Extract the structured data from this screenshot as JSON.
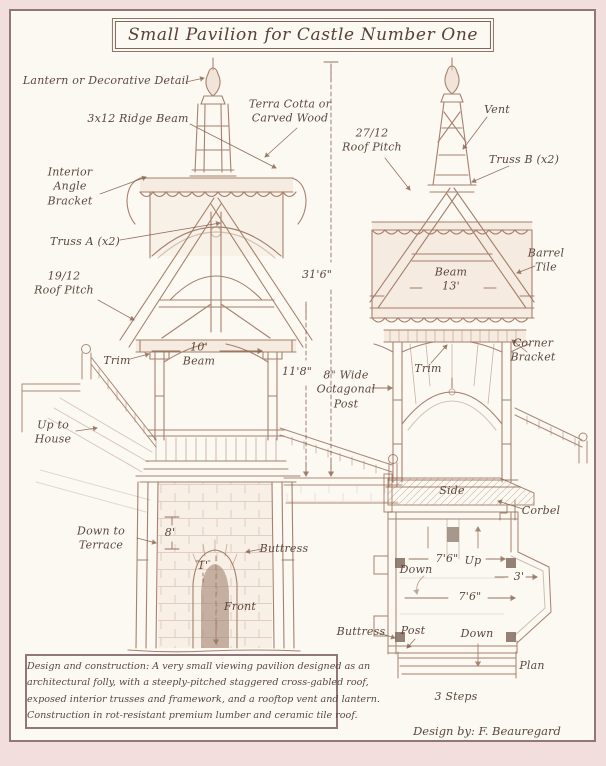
{
  "title": {
    "text": "Small Pavilion for Castle Number One"
  },
  "credit": {
    "text": "Design by: F. Beauregard"
  },
  "note_box": {
    "lines": [
      "Design and construction: A very small viewing pavilion designed as an",
      "architectural folly, with a steeply-pitched staggered cross-gabled roof,",
      "exposed interior trusses and framework, and a rooftop vent and lantern.",
      "Construction in rot-resistant premium lumber and ceramic tile roof."
    ]
  },
  "colors": {
    "margin": "#f1dedd",
    "frame": "#90777a",
    "paper": "#fcf9f3",
    "ink": "#8a5a42",
    "label": "#5c473d",
    "title": "#584237"
  },
  "annotations": [
    {
      "name": "lantern-detail",
      "text": "Lantern or Decorative Detail",
      "x": 106,
      "y": 81
    },
    {
      "name": "ridge-beam",
      "text": "3x12 Ridge Beam",
      "x": 138,
      "y": 119
    },
    {
      "name": "interior-angle-bracket",
      "text": "Interior\nAngle\nBracket",
      "x": 70,
      "y": 187
    },
    {
      "name": "truss-a",
      "text": "Truss A (x2)",
      "x": 85,
      "y": 242
    },
    {
      "name": "roof-pitch-19-12",
      "text": "19/12\nRoof Pitch",
      "x": 64,
      "y": 284
    },
    {
      "name": "terra-cotta",
      "text": "Terra Cotta or\nCarved Wood",
      "x": 290,
      "y": 112
    },
    {
      "name": "roof-pitch-27-12",
      "text": "27/12\nRoof Pitch",
      "x": 372,
      "y": 141
    },
    {
      "name": "vent",
      "text": "Vent",
      "x": 497,
      "y": 110
    },
    {
      "name": "truss-b",
      "text": "Truss B (x2)",
      "x": 524,
      "y": 160
    },
    {
      "name": "barrel-tile",
      "text": "Barrel\nTile",
      "x": 546,
      "y": 261
    },
    {
      "name": "beam-13",
      "text": "Beam\n13'",
      "x": 451,
      "y": 280
    },
    {
      "name": "corner-bracket",
      "text": "Corner\nBracket",
      "x": 533,
      "y": 351
    },
    {
      "name": "trim-left",
      "text": "Trim",
      "x": 117,
      "y": 361
    },
    {
      "name": "beam-10",
      "text": "10'\nBeam",
      "x": 199,
      "y": 355
    },
    {
      "name": "trim-right",
      "text": "Trim",
      "x": 428,
      "y": 369
    },
    {
      "name": "dim-31-6",
      "text": "31'6\"",
      "x": 317,
      "y": 275
    },
    {
      "name": "dim-11-8",
      "text": "11'8\"",
      "x": 297,
      "y": 372
    },
    {
      "name": "octagonal-post",
      "text": "8\" Wide\nOctagonal\nPost",
      "x": 346,
      "y": 390
    },
    {
      "name": "up-to-house",
      "text": "Up to\nHouse",
      "x": 53,
      "y": 433
    },
    {
      "name": "down-to-terrace",
      "text": "Down to\nTerrace",
      "x": 101,
      "y": 539
    },
    {
      "name": "dim-8",
      "text": "8'",
      "x": 170,
      "y": 533
    },
    {
      "name": "buttress-left",
      "text": "Buttress",
      "x": 284,
      "y": 549
    },
    {
      "name": "dim-1",
      "text": "1'",
      "x": 203,
      "y": 566
    },
    {
      "name": "front-view",
      "text": "Front",
      "x": 240,
      "y": 607
    },
    {
      "name": "side-view",
      "text": "Side",
      "x": 452,
      "y": 491
    },
    {
      "name": "corbel",
      "text": "Corbel",
      "x": 541,
      "y": 511
    },
    {
      "name": "down-plan-upper",
      "text": "Down",
      "x": 416,
      "y": 570
    },
    {
      "name": "dim-7-6-upper",
      "text": "7'6\"",
      "x": 447,
      "y": 559
    },
    {
      "name": "up-plan",
      "text": "Up",
      "x": 473,
      "y": 561
    },
    {
      "name": "dim-3",
      "text": "3'",
      "x": 519,
      "y": 577
    },
    {
      "name": "dim-7-6-lower",
      "text": "7'6\"",
      "x": 470,
      "y": 597
    },
    {
      "name": "buttress-plan",
      "text": "Buttress",
      "x": 361,
      "y": 632
    },
    {
      "name": "post-plan",
      "text": "Post",
      "x": 413,
      "y": 631
    },
    {
      "name": "down-plan-lower",
      "text": "Down",
      "x": 477,
      "y": 634
    },
    {
      "name": "plan-view",
      "text": "Plan",
      "x": 532,
      "y": 666
    },
    {
      "name": "three-steps",
      "text": "3 Steps",
      "x": 456,
      "y": 697
    }
  ]
}
